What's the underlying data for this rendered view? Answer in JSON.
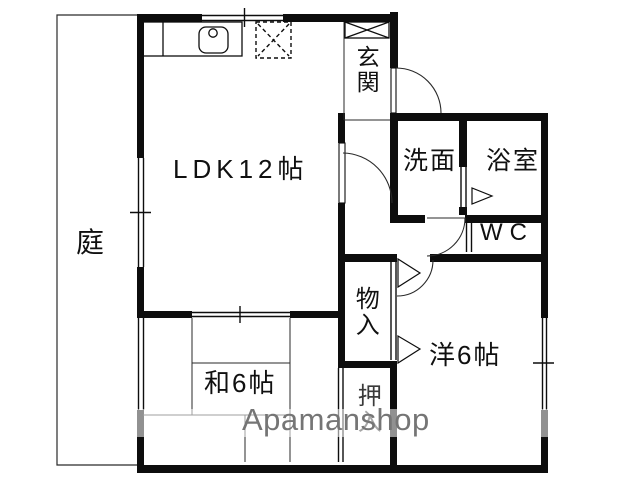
{
  "plan": {
    "type": "apartment-floor-plan",
    "rooms": {
      "garden": {
        "label": "庭"
      },
      "ldk": {
        "label": "LDK12帖"
      },
      "genkan": {
        "label": "玄関"
      },
      "washroom": {
        "label": "洗面"
      },
      "bathroom": {
        "label": "浴室"
      },
      "wc": {
        "label": "WC"
      },
      "storage": {
        "label": "物入"
      },
      "western_room": {
        "label": "洋6帖"
      },
      "japanese_room": {
        "label": "和6帖"
      },
      "closet": {
        "label": "押入"
      }
    },
    "fixtures": [
      "kitchen-sink",
      "stove-dashed-box",
      "shoe-cabinet"
    ],
    "colors": {
      "wall": "#0d0d0d",
      "thin_line": "#2a2a2a",
      "background": "#ffffff"
    }
  },
  "watermark": {
    "text": "Apamanshop",
    "color": "#757575",
    "band_color": "rgba(255,255,255,0.55)"
  }
}
